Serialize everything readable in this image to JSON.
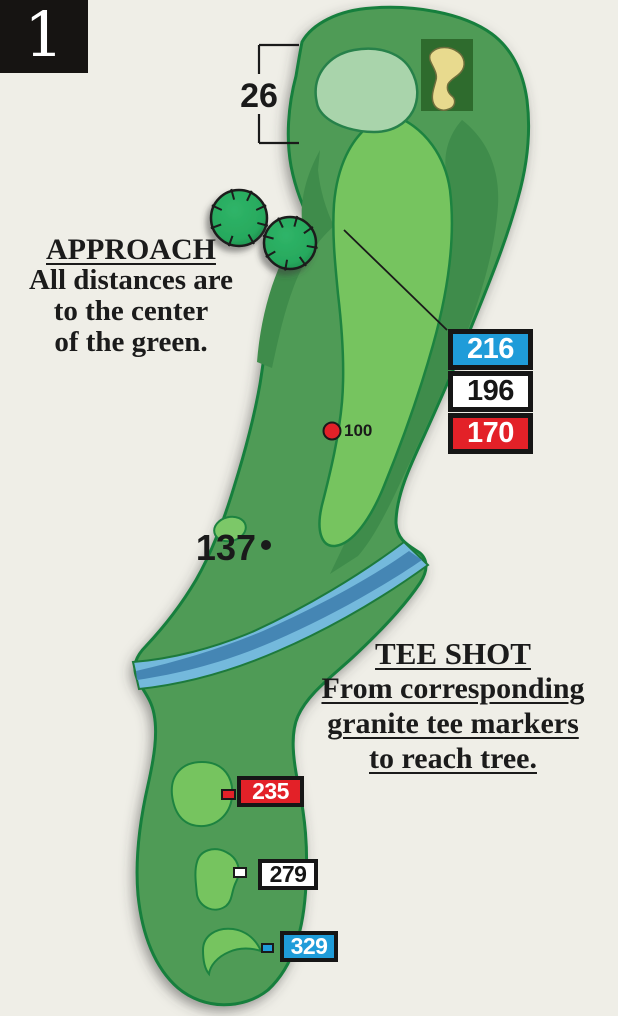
{
  "hole": {
    "number": "1"
  },
  "green_depth_label": "26",
  "approach_note": {
    "title": "APPROACH",
    "lines": [
      "All distances are",
      "to the center",
      "of the green."
    ]
  },
  "tee_shot_note": {
    "title": "TEE SHOT",
    "lines": [
      "From corresponding",
      "granite tee markers",
      "to reach tree."
    ]
  },
  "fairway_labels": {
    "yardage_100": "100",
    "yardage_137": "137"
  },
  "approach_markers": [
    {
      "value": "216",
      "color": "#1f9cd9",
      "text_color": "#ffffff"
    },
    {
      "value": "196",
      "color": "#ffffff",
      "text_color": "#161616"
    },
    {
      "value": "170",
      "color": "#e32128",
      "text_color": "#ffffff"
    }
  ],
  "tee_markers": [
    {
      "value": "235",
      "color": "#e32128",
      "text_color": "#ffffff"
    },
    {
      "value": "279",
      "color": "#ffffff",
      "text_color": "#161616"
    },
    {
      "value": "329",
      "color": "#1f9cd9",
      "text_color": "#ffffff"
    }
  ],
  "map_colors": {
    "background": "#efeee7",
    "rough": "#4f9b57",
    "rough_dark": "#3f8c4b",
    "fairway": "#76c45f",
    "putting_green": "#a9d4ab",
    "outline": "#157f3c",
    "bunker_sand": "#e8da8e",
    "bunker_patch": "#2e6b2d",
    "water_light": "#74b9dc",
    "water_dark": "#4586b4",
    "tree": "#27a95d",
    "marker_black": "#161616"
  }
}
